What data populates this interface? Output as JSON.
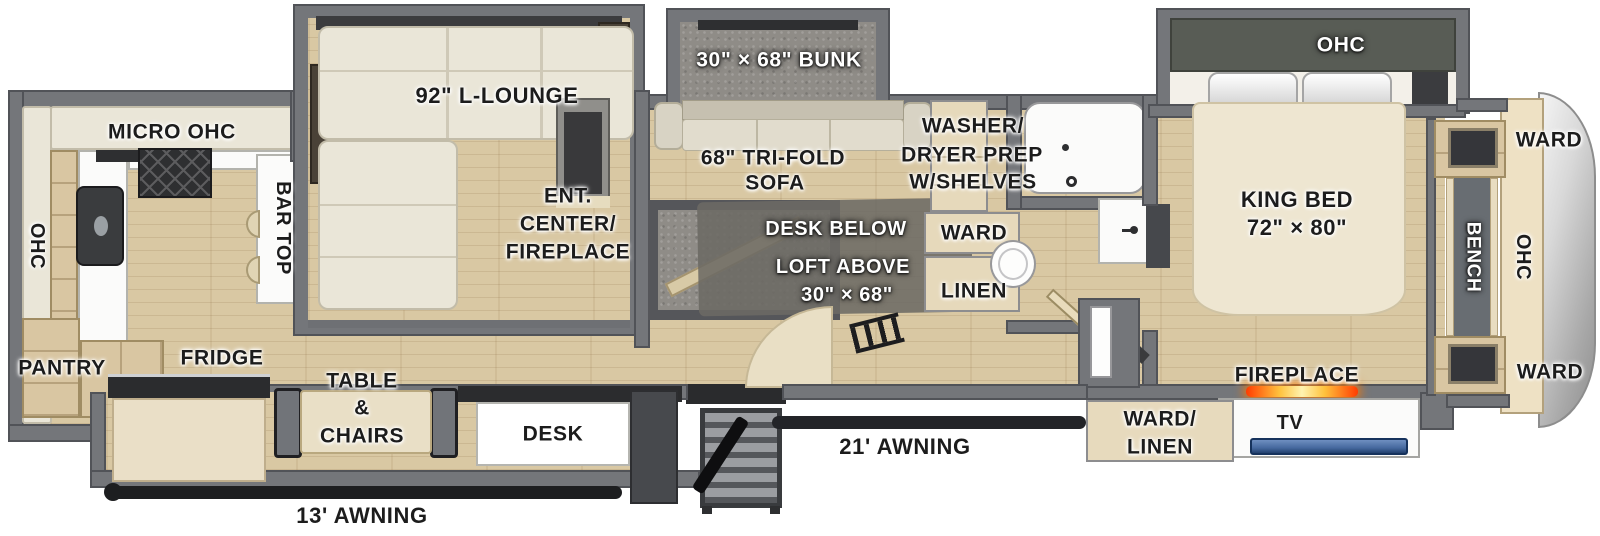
{
  "title": "RV fifth-wheel floorplan",
  "colors": {
    "floor_wood": "#d9c8a3",
    "wall_gray": "#74767a",
    "wall_dark": "#515358",
    "carpet_gray": "#8f8c87",
    "sofa_cream": "#eae6d8",
    "cabinet_tan": "#d9c6a2",
    "counter_white": "#fbfbfa",
    "appliance_dark": "#2e2f31",
    "slide_ohc_green": "#585c55",
    "fireplace_glow": "#ff7a00",
    "tv_screen": "#46699f",
    "front_cap_silver": "#c9c9c9",
    "label_black": "#1c1c1c",
    "label_white": "#ffffff"
  },
  "labels": {
    "kitchen_ohc": "OHC",
    "micro_ohc": "MICRO  OHC",
    "bar_top": "BAR TOP",
    "pantry": "PANTRY",
    "fridge": "FRIDGE",
    "l_lounge": "92\" L-LOUNGE",
    "ent_center_line1": "ENT.",
    "ent_center_line2": "CENTER/",
    "ent_center_line3": "FIREPLACE",
    "table_chairs_line1": "TABLE",
    "table_chairs_line2": "&",
    "table_chairs_line3": "CHAIRS",
    "desk": "DESK",
    "awning_13": "13' AWNING",
    "bunk": "30\" × 68\" BUNK",
    "trifold_line1": "68\" TRI-FOLD",
    "trifold_line2": "SOFA",
    "desk_below": "DESK BELOW",
    "loft_above_line1": "LOFT ABOVE",
    "loft_above_line2": "30\" × 68\"",
    "washer_line1": "WASHER/",
    "washer_line2": "DRYER PREP",
    "washer_line3": "W/SHELVES",
    "ward_hall": "WARD",
    "linen_hall": "LINEN",
    "awning_21": "21' AWNING",
    "king_bed_line1": "KING BED",
    "king_bed_line2": "72\" × 80\"",
    "bedroom_ohc": "OHC",
    "ward_cap_top": "WARD",
    "bench": "BENCH",
    "cap_ohc": "OHC",
    "ward_cap_bottom": "WARD",
    "fireplace": "FIREPLACE",
    "tv": "TV",
    "ward_linen_line1": "WARD/",
    "ward_linen_line2": "LINEN"
  }
}
